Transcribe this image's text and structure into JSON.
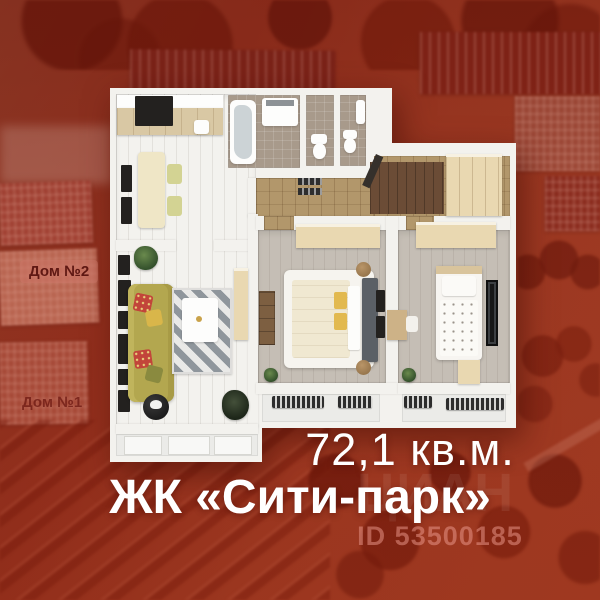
{
  "listing": {
    "area_text": "72,1 кв.м.",
    "complex_name": "ЖК «Сити-парк»",
    "listing_id": "ID 53500185",
    "watermark": "ЦИАН"
  },
  "background": {
    "house2_label": "Дом №2",
    "house1_label": "Дом №1",
    "description": "aerial photo of residential complex with red overlay"
  },
  "floorplan": {
    "type": "3d-top-down apartment plan",
    "rooms": [
      "kitchen-dining",
      "bathroom",
      "wc-1",
      "wc-2",
      "entry-hall",
      "living-room",
      "bedroom-main",
      "bedroom-second",
      "loggia-living",
      "loggia-bedroom-main",
      "loggia-bedroom-second"
    ]
  },
  "colors": {
    "backdrop_red": "#9a3520",
    "building_dark_red": "#7c241b",
    "caption_white": "#ffffff",
    "id_text_pink": "#ee9c8f",
    "wall_white": "#f3f2ee",
    "hall_floor_tan": "#b2976b",
    "wood_floor": "#cdc5bb",
    "sofa_olive": "#b3a74f",
    "pillow_yellow": "#e2b94f",
    "wardrobe_cream": "#e9d8b1"
  }
}
